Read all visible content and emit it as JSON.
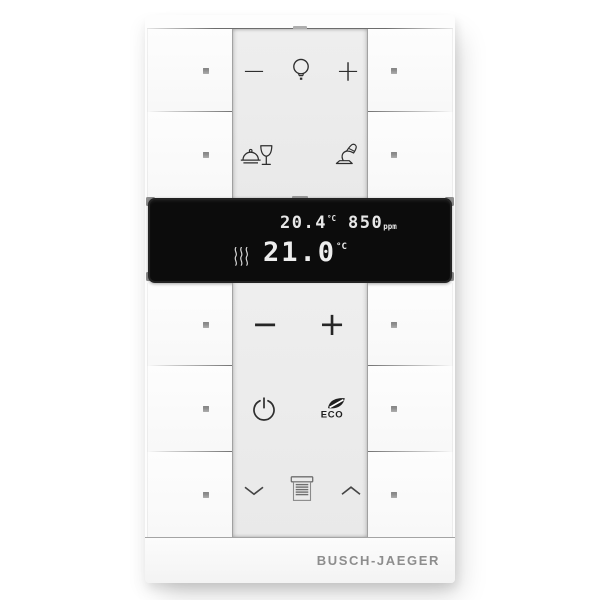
{
  "branding": {
    "label": "BUSCH-JAEGER"
  },
  "display": {
    "ambient_temperature": {
      "value": "20.4",
      "unit": "°C"
    },
    "air_quality": {
      "value": "850",
      "unit": "ppm"
    },
    "setpoint_temperature": {
      "value": "21.0",
      "unit": "°C"
    },
    "status_icons": [
      "heating-waves-icon"
    ],
    "colors": {
      "background": "#0c0c0c",
      "text": "#ededed"
    }
  },
  "controls": {
    "rows": [
      {
        "name": "light-dimmer",
        "minus_label": "−",
        "plus_label": "+",
        "icons": [
          "lightbulb-icon"
        ]
      },
      {
        "name": "scenes",
        "icons": [
          "dining-scene-icon",
          "desk-lamp-icon"
        ]
      },
      {
        "name": "temperature-adjust",
        "minus_label": "−",
        "plus_label": "+"
      },
      {
        "name": "mode",
        "icons": [
          "power-icon",
          "eco-leaf-icon"
        ],
        "eco_label": "ECO"
      },
      {
        "name": "blinds",
        "icons": [
          "chevron-down-icon",
          "blinds-icon",
          "chevron-up-icon"
        ]
      }
    ],
    "side_buttons": {
      "count": 10,
      "indicator_icon": "led-square",
      "indicator_color": "#9a9a9a"
    }
  },
  "colors": {
    "body": "#fdfdfd",
    "center_panel": "#ebebeb",
    "icon": "#2e2e2e",
    "brand_text": "#8d8d8d"
  }
}
